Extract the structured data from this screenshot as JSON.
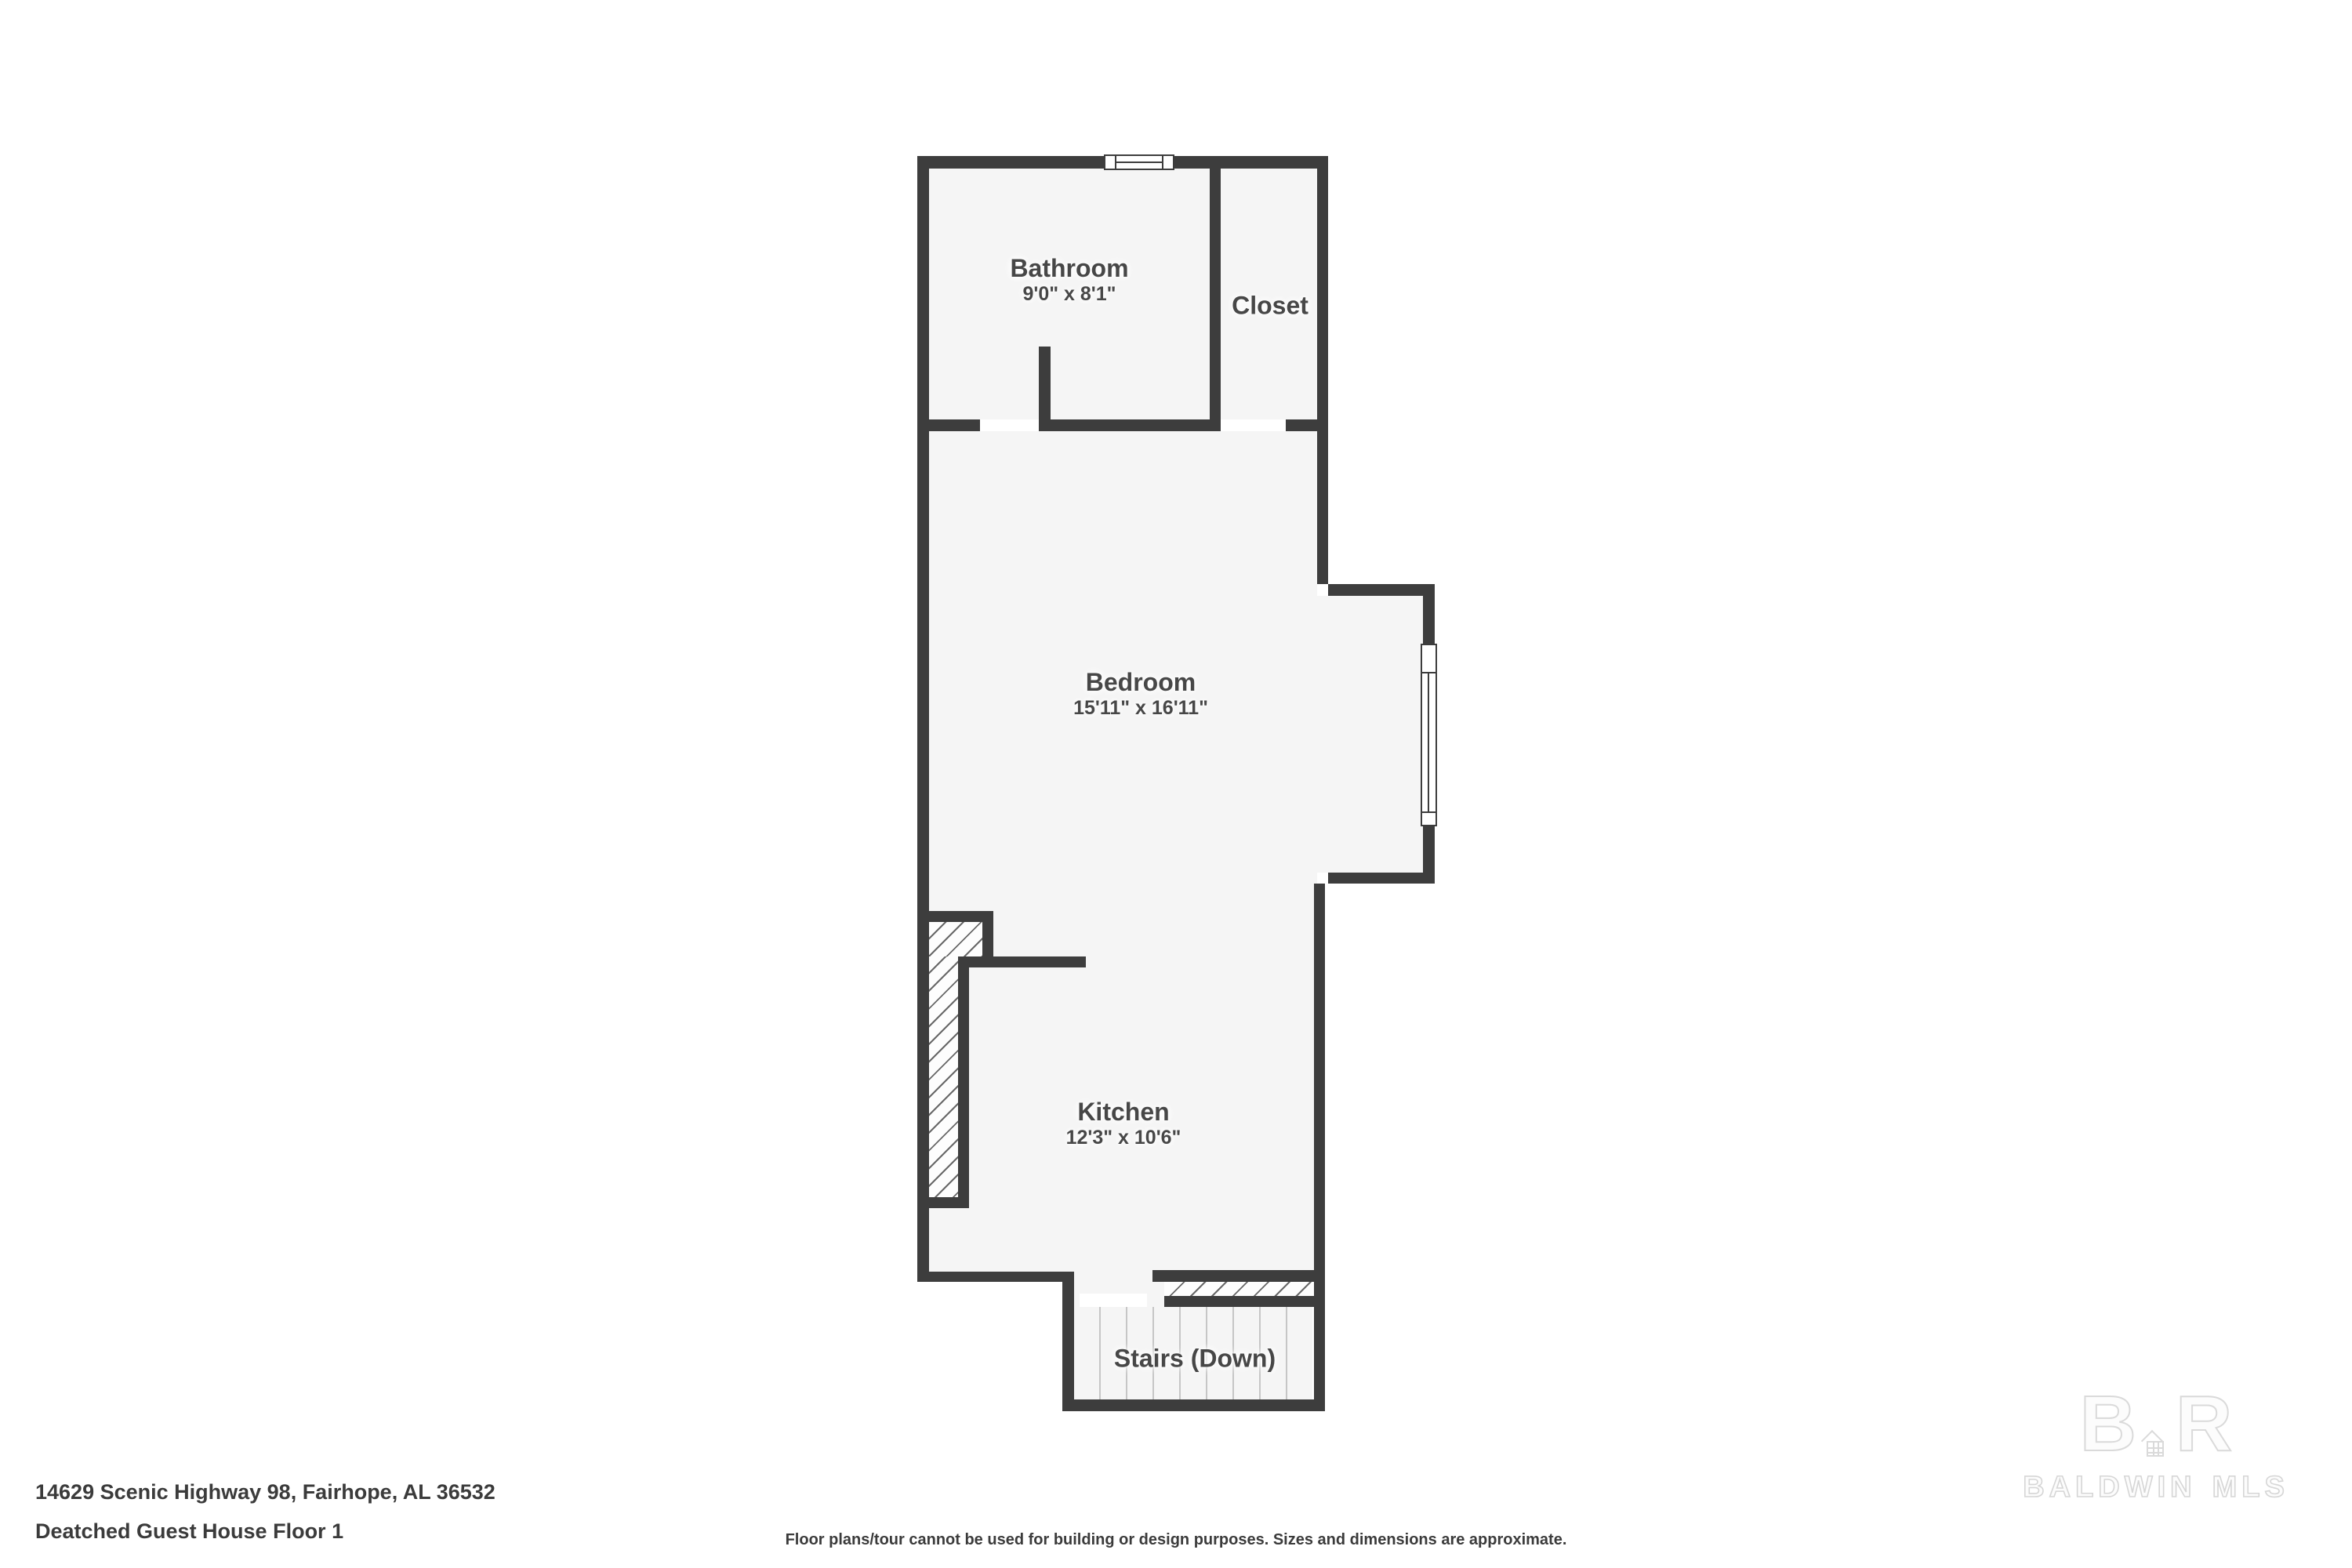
{
  "plan": {
    "wall_color": "#3d3d3d",
    "room_fill_color": "#f5f5f5",
    "rooms": {
      "bathroom": {
        "name": "Bathroom",
        "dimensions": "9'0\" x 8'1\""
      },
      "closet": {
        "name": "Closet"
      },
      "bedroom": {
        "name": "Bedroom",
        "dimensions": "15'11\" x 16'11\""
      },
      "kitchen": {
        "name": "Kitchen",
        "dimensions": "12'3\" x 10'6\""
      },
      "stairs": {
        "name": "Stairs (Down)"
      }
    }
  },
  "footer": {
    "address_line1": "14629 Scenic Highway 98, Fairhope, AL 36532",
    "address_line2": "Deatched Guest House Floor 1",
    "disclaimer": "Floor plans/tour cannot be used for building or design purposes. Sizes and dimensions are approximate."
  },
  "watermark": {
    "monogram_left": "B",
    "monogram_right": "R",
    "brand_primary": "BALDWIN",
    "brand_secondary": "MLS"
  }
}
